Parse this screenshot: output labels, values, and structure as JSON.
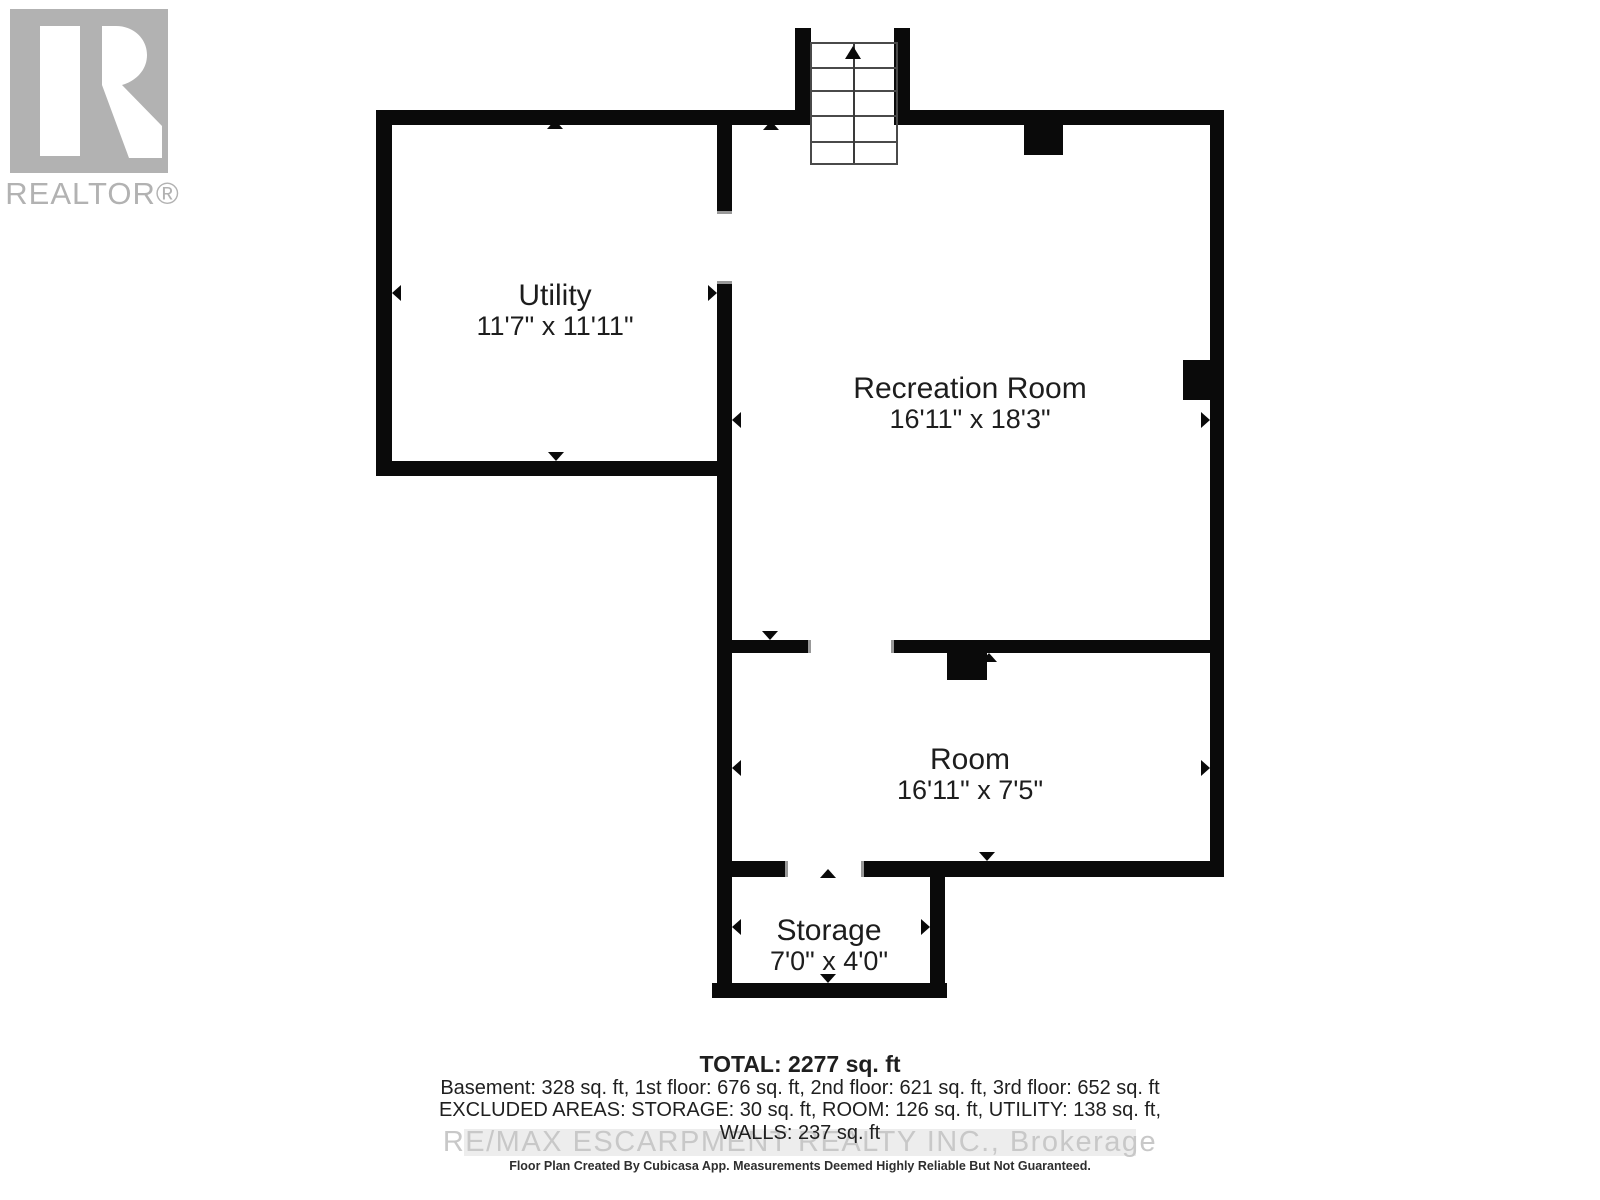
{
  "logo": {
    "realtor_label": "REALTOR®"
  },
  "rooms": [
    {
      "id": "utility",
      "name": "Utility",
      "dims": "11'7\" x 11'11\""
    },
    {
      "id": "recreation",
      "name": "Recreation Room",
      "dims": "16'11\" x 18'3\""
    },
    {
      "id": "room",
      "name": "Room",
      "dims": "16'11\" x 7'5\""
    },
    {
      "id": "storage",
      "name": "Storage",
      "dims": "7'0\" x 4'0\""
    }
  ],
  "summary": {
    "total": "TOTAL: 2277 sq. ft",
    "floors": "Basement: 328 sq. ft, 1st floor: 676 sq. ft, 2nd floor: 621 sq. ft, 3rd floor: 652 sq. ft",
    "excluded": "EXCLUDED AREAS: STORAGE: 30 sq. ft, ROOM: 126 sq. ft, UTILITY: 138 sq. ft,",
    "walls": "WALLS: 237 sq. ft",
    "disclaimer": "Floor Plan Created By Cubicasa App. Measurements Deemed Highly Reliable But Not Guaranteed."
  },
  "watermark": "RE/MAX ESCARPMENT REALTY INC., Brokerage",
  "colors": {
    "wall": "#0a0a0a",
    "label_text": "#1d1d1d",
    "logo_gray": "#b2b2b2",
    "watermark_gray": "#c8c8c8",
    "watermark_band": "#ededed"
  }
}
